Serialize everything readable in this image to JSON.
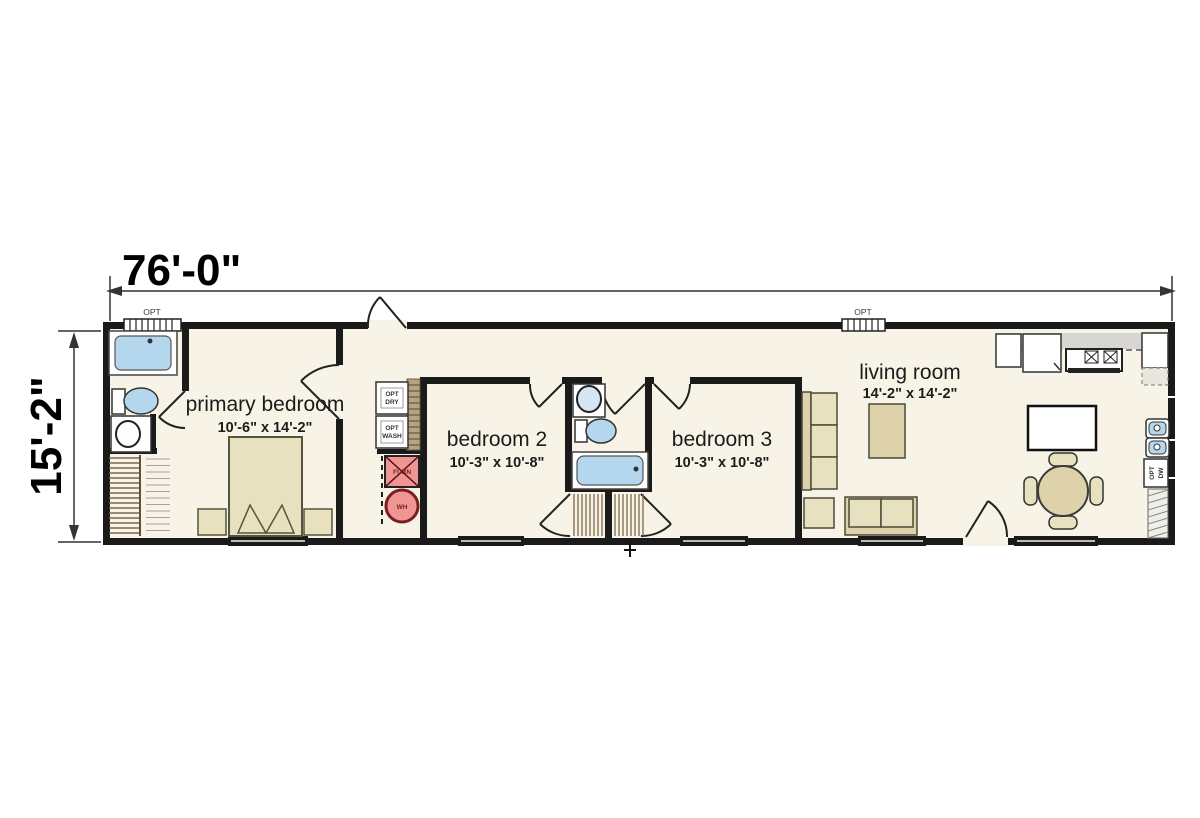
{
  "dimensions": {
    "width": "76'-0\"",
    "height": "15'-2\""
  },
  "rooms": [
    {
      "name": "primary bedroom",
      "size": "10'-6\" x 14'-2\""
    },
    {
      "name": "bedroom 2",
      "size": "10'-3\" x 10'-8\""
    },
    {
      "name": "bedroom 3",
      "size": "10'-3\" x 10'-8\""
    },
    {
      "name": "living room",
      "size": "14'-2\" x 14'-2\""
    }
  ],
  "fixtures": {
    "opt_window": "OPT",
    "dryer_line1": "OPT",
    "dryer_line2": "DRY",
    "washer_line1": "OPT",
    "washer_line2": "WASH",
    "furnace": "FURN",
    "water_heater": "WH",
    "dishwasher_line1": "OPT",
    "dishwasher_line2": "DW"
  },
  "colors": {
    "wall": "#1a1a1a",
    "floor": "#f8f3e7",
    "water": "#b4d7ee",
    "furniture": "#e8e1bf",
    "furniture-dark": "#ddd2a9",
    "equipment": "#f09494"
  }
}
